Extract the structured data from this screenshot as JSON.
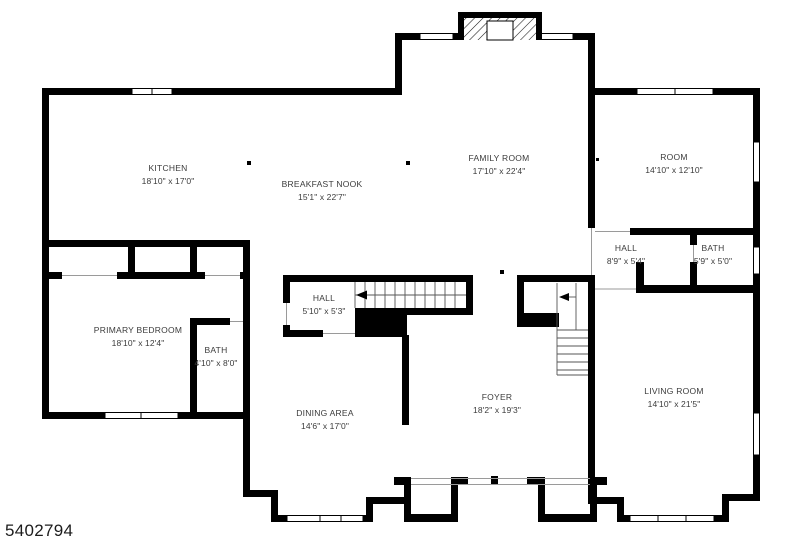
{
  "page": {
    "photo_id": "5402794"
  },
  "rooms": [
    {
      "name": "KITCHEN",
      "dims": "18'10\" x 17'0\""
    },
    {
      "name": "BREAKFAST NOOK",
      "dims": "15'1\" x 22'7\""
    },
    {
      "name": "FAMILY ROOM",
      "dims": "17'10\" x 22'4\""
    },
    {
      "name": "ROOM",
      "dims": "14'10\" x 12'10\""
    },
    {
      "name": "HALL",
      "dims": "8'9\" x 5'4\""
    },
    {
      "name": "BATH",
      "dims": "5'9\" x 5'0\""
    },
    {
      "name": "HALL",
      "dims": "5'10\" x 5'3\""
    },
    {
      "name": "PRIMARY BEDROOM",
      "dims": "18'10\" x 12'4\""
    },
    {
      "name": "BATH",
      "dims": "4'10\" x 8'0\""
    },
    {
      "name": "DINING AREA",
      "dims": "14'6\" x 17'0\""
    },
    {
      "name": "FOYER",
      "dims": "18'2\" x 19'3\""
    },
    {
      "name": "LIVING ROOM",
      "dims": "14'10\" x 21'5\""
    }
  ],
  "icons": [
    "fireplace-icon",
    "staircase-main",
    "staircase-foyer",
    "stair-direction-arrow",
    "window-symbol",
    "door-opening"
  ],
  "colors": {
    "wall": "#000000",
    "background": "#ffffff",
    "label": "#3b3b3b",
    "tread_line": "#555555",
    "opening_line": "#9a9a9a"
  }
}
